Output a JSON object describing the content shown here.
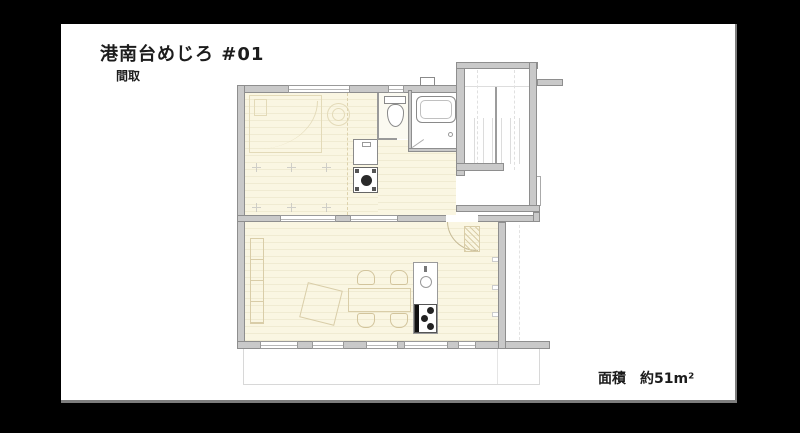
{
  "slide": {
    "title": "港南台めじろ #01",
    "subtitle": "間取",
    "area_label": "面積　約51m²"
  },
  "colors": {
    "background": "#000000",
    "slide": "#ffffff",
    "text": "#1c1c1c",
    "wall": "#c9c9c9",
    "floor": "#faf6e2",
    "furniture-line": "#d9cda8"
  },
  "floor_plan": {
    "type": "apartment-floor-plan",
    "fixtures": [
      "bed",
      "round-chair",
      "floor-grid-ticks",
      "washbasin",
      "washing-machine",
      "toilet",
      "hand-wash-basin",
      "bathtub",
      "staircase",
      "stair-hall",
      "kitchen-counter",
      "kitchen-sink",
      "gas-stove",
      "dining-table",
      "dining-chairs",
      "rug",
      "side-shelf",
      "entrance-door",
      "balcony",
      "windows"
    ]
  }
}
